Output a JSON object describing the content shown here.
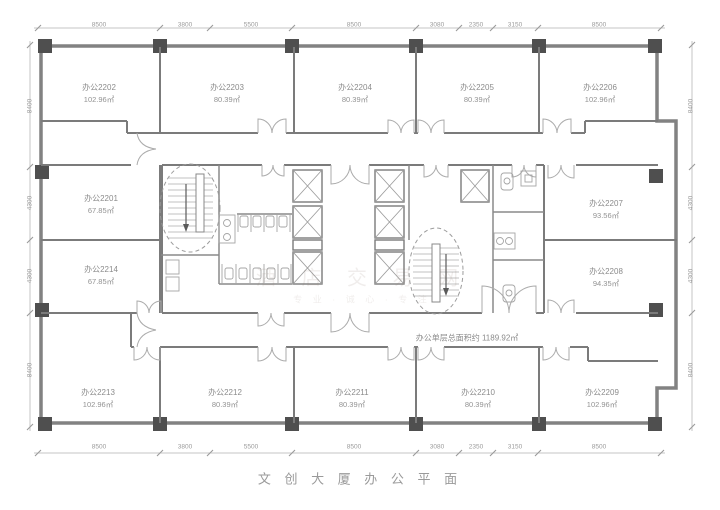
{
  "plan": {
    "title": "文 创 大 厦 办 公 平 面",
    "total_area_label": "办公单层总面积约 1189.92㎡",
    "watermark_line1": "酒 店 交 易 网",
    "watermark_line2": "专 业 · 诚 心 · 专 注",
    "rooms": [
      {
        "name": "办公2202",
        "area": "102.96㎡",
        "x": 99,
        "y": 94
      },
      {
        "name": "办公2203",
        "area": "80.39㎡",
        "x": 227,
        "y": 94
      },
      {
        "name": "办公2204",
        "area": "80.39㎡",
        "x": 355,
        "y": 94
      },
      {
        "name": "办公2205",
        "area": "80.39㎡",
        "x": 477,
        "y": 94
      },
      {
        "name": "办公2206",
        "area": "102.96㎡",
        "x": 600,
        "y": 94
      },
      {
        "name": "办公2201",
        "area": "67.85㎡",
        "x": 101,
        "y": 205
      },
      {
        "name": "办公2207",
        "area": "93.56㎡",
        "x": 606,
        "y": 210
      },
      {
        "name": "办公2214",
        "area": "67.85㎡",
        "x": 101,
        "y": 276
      },
      {
        "name": "办公2208",
        "area": "94.35㎡",
        "x": 606,
        "y": 278
      },
      {
        "name": "办公2213",
        "area": "102.96㎡",
        "x": 98,
        "y": 399
      },
      {
        "name": "办公2212",
        "area": "80.39㎡",
        "x": 225,
        "y": 399
      },
      {
        "name": "办公2211",
        "area": "80.39㎡",
        "x": 352,
        "y": 399
      },
      {
        "name": "办公2210",
        "area": "80.39㎡",
        "x": 478,
        "y": 399
      },
      {
        "name": "办公2209",
        "area": "102.96㎡",
        "x": 602,
        "y": 399
      }
    ],
    "dims_top": [
      {
        "label": "8500",
        "x": 99
      },
      {
        "label": "3800",
        "x": 185
      },
      {
        "label": "5500",
        "x": 251
      },
      {
        "label": "8500",
        "x": 354
      },
      {
        "label": "3080",
        "x": 437
      },
      {
        "label": "2350",
        "x": 476
      },
      {
        "label": "3150",
        "x": 515
      },
      {
        "label": "8500",
        "x": 599
      }
    ],
    "dims_bottom": [
      {
        "label": "8500",
        "x": 99
      },
      {
        "label": "3800",
        "x": 185
      },
      {
        "label": "5500",
        "x": 251
      },
      {
        "label": "8500",
        "x": 354
      },
      {
        "label": "3080",
        "x": 437
      },
      {
        "label": "2350",
        "x": 476
      },
      {
        "label": "3150",
        "x": 515
      },
      {
        "label": "8500",
        "x": 599
      }
    ],
    "dims_left": [
      {
        "label": "8400",
        "y": 106
      },
      {
        "label": "4300",
        "y": 203
      },
      {
        "label": "4300",
        "y": 276
      },
      {
        "label": "8400",
        "y": 370
      }
    ],
    "dims_right": [
      {
        "label": "8400",
        "y": 106
      },
      {
        "label": "4300",
        "y": 203
      },
      {
        "label": "4300",
        "y": 276
      },
      {
        "label": "8400",
        "y": 370
      }
    ]
  }
}
